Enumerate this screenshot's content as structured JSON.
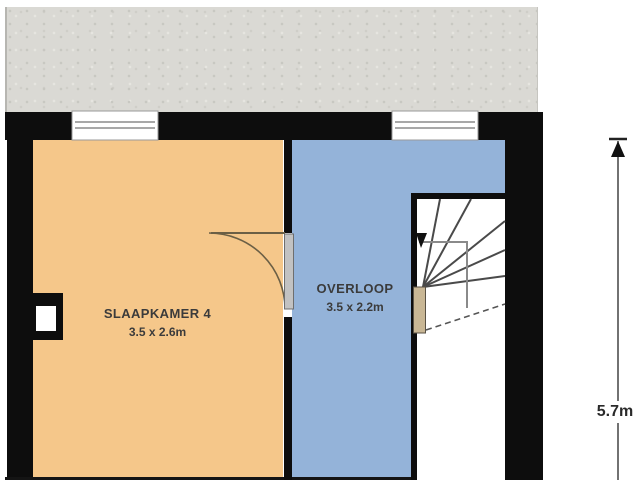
{
  "plan": {
    "type": "floorplan",
    "rooms": [
      {
        "name": "SLAAPKAMER 4",
        "size": "3.5 x 2.6m",
        "fill": "#f5c78a"
      },
      {
        "name": "OVERLOOP",
        "size": "3.5 x 2.2m",
        "fill": "#94b3d9"
      }
    ],
    "dimension": {
      "label": "5.7m"
    },
    "features": [
      "roof-area",
      "window-icon",
      "window-icon",
      "door-icon",
      "stairs-icon",
      "chimney-icon",
      "dimension-arrow-icon"
    ],
    "palette": {
      "wall": "#0d0d0d",
      "roof": "#dad9d4",
      "bedroom": "#f5c78a",
      "overloop": "#94b3d9",
      "door_swing": "#6b5f45",
      "tread_line": "#4a4a4a",
      "newel": "#c9b795"
    }
  }
}
